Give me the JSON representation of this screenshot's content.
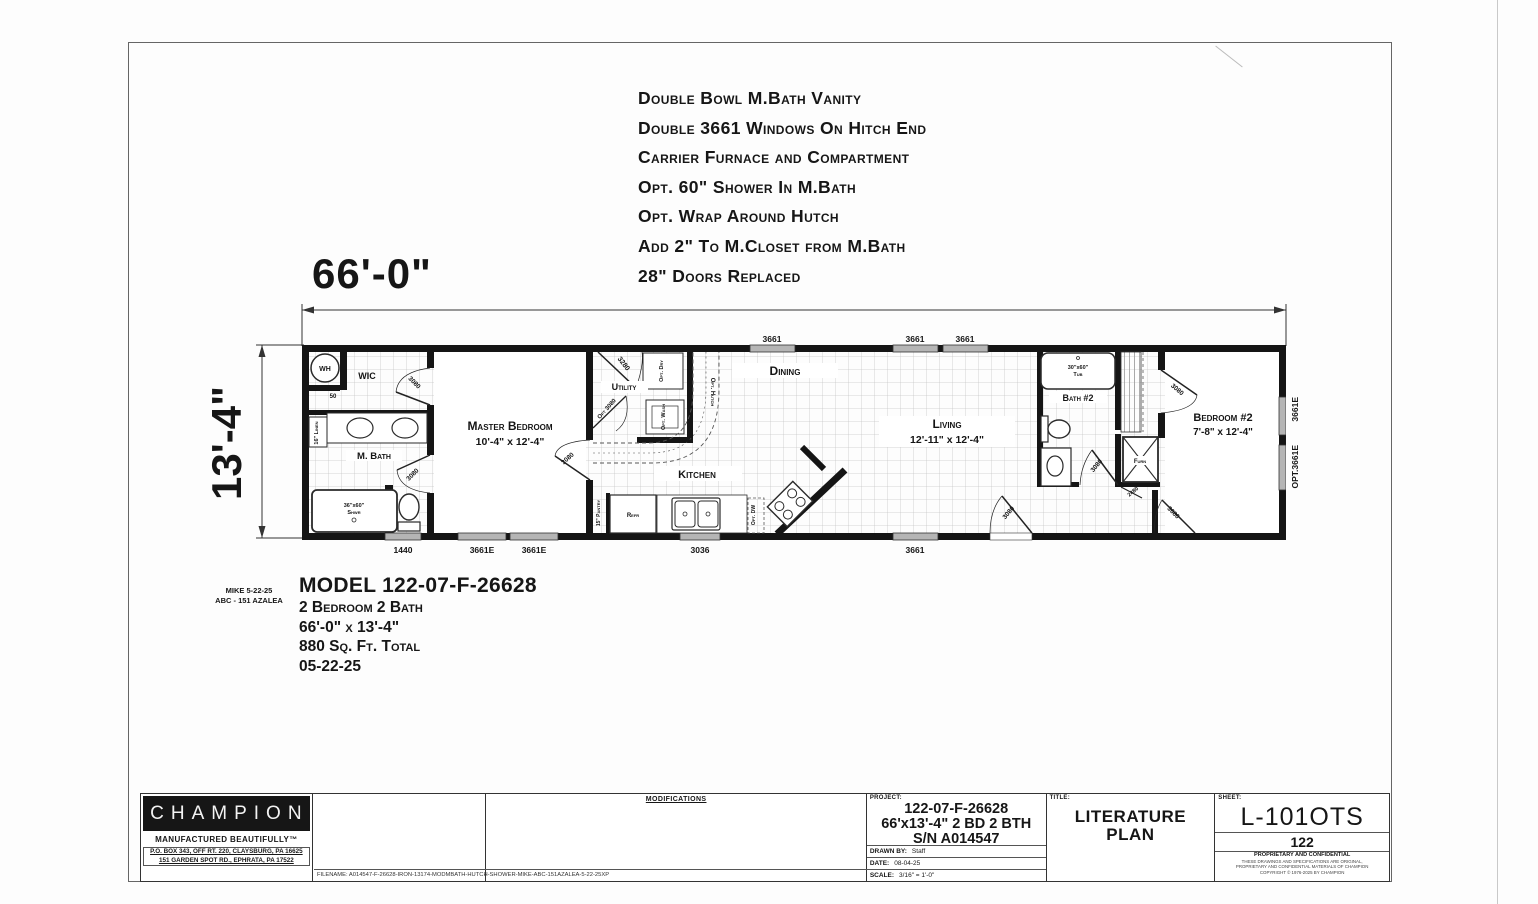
{
  "features": {
    "lines": [
      "Double Bowl M.Bath Vanity",
      "Double 3661 Windows On Hitch End",
      "Carrier Furnace and Compartment",
      "Opt. 60\" Shower In M.Bath",
      "Opt. Wrap Around Hutch",
      "Add 2\" To M.Closet from M.Bath",
      "28\" Doors Replaced"
    ]
  },
  "dimensions": {
    "overall_width": "66'-0\"",
    "overall_depth": "13'-4\""
  },
  "plan": {
    "rooms": {
      "master_bedroom_name": "Master Bedroom",
      "master_bedroom_size": "10'-4\" x 12'-4\"",
      "living_name": "Living",
      "living_size": "12'-11\" x 12'-4\"",
      "bedroom2_name": "Bedroom #2",
      "bedroom2_size": "7'-8\" x 12'-4\"",
      "dining": "Dining",
      "kitchen": "Kitchen",
      "utility": "Utility",
      "mbath": "M. Bath",
      "wic": "WIC",
      "bath2": "Bath #2"
    },
    "fixtures": {
      "wh": "WH",
      "wh_size": "50",
      "linen": "16\" Linen",
      "shower_size": "36\"x60\"",
      "shower": "Shwr",
      "tub_size": "30\"x60\"",
      "tub": "Tub",
      "refr": "Refr",
      "pantry": "15\" Pantry",
      "furn": "Furn",
      "opt_dry": "Opt. Dry",
      "opt_wash": "Opt. Wash",
      "opt_hutch": "Opt. Hutch",
      "opt_dw": "Opt. DW",
      "wb": "WB"
    },
    "doors": {
      "d3080": "3080",
      "d3280": "3280",
      "d2480": "2480",
      "opt3080": "Opt 3080"
    },
    "windows": {
      "top": [
        "3661",
        "3661",
        "3661"
      ],
      "bottom": [
        "1440",
        "3661E",
        "3661E",
        "3036",
        "3661"
      ],
      "right": [
        "3661E",
        "OPT.3661E"
      ]
    }
  },
  "model": {
    "line1": "MODEL 122-07-F-26628",
    "line2": "2 Bedroom 2 Bath",
    "line3": "66'-0\" x 13'-4\"",
    "line4": "880 Sq. Ft. Total",
    "line5": "05-22-25"
  },
  "note": {
    "line1": "MIKE 5-22-25",
    "line2": "ABC - 151 AZALEA"
  },
  "title_block": {
    "logo": "CHAMPION",
    "tagline": "MANUFACTURED BEAUTIFULLY™",
    "address1": "P.O. BOX 343, OFF RT. 220, CLAYSBURG, PA 16625",
    "address2": "151 GARDEN SPOT RD., EPHRATA, PA 17522",
    "filename": "FILENAME: A014547-F-26628-IRON-13174-MODMBATH-HUTCH-SHOWER-MIKE-ABC-151AZALEA-5-22-25XP",
    "modifications_label": "MODIFICATIONS",
    "project_label": "PROJECT:",
    "project_line1": "122-07-F-26628",
    "project_line2": "66'x13'-4\"  2 BD  2 BTH",
    "project_line3": "S/N A014547",
    "drawn_by_label": "DRAWN BY:",
    "drawn_by": "Staff",
    "date_label": "DATE:",
    "date": "08-04-25",
    "scale_label": "SCALE:",
    "scale": "3/16\" = 1'-0\"",
    "title_label": "TITLE:",
    "title_line1": "LITERATURE",
    "title_line2": "PLAN",
    "sheet_label": "SHEET:",
    "sheet": "L-101OTS",
    "sheet_num": "122",
    "confidential1": "PROPRIETARY AND CONFIDENTIAL",
    "confidential2": "THESE DRAWINGS AND SPECIFICATIONS ARE ORIGINAL,",
    "confidential3": "PROPRIETARY AND CONFIDENTIAL MATERIALS OF CHAMPION",
    "confidential4": "COPYRIGHT © 1976-2025 BY CHAMPION"
  }
}
